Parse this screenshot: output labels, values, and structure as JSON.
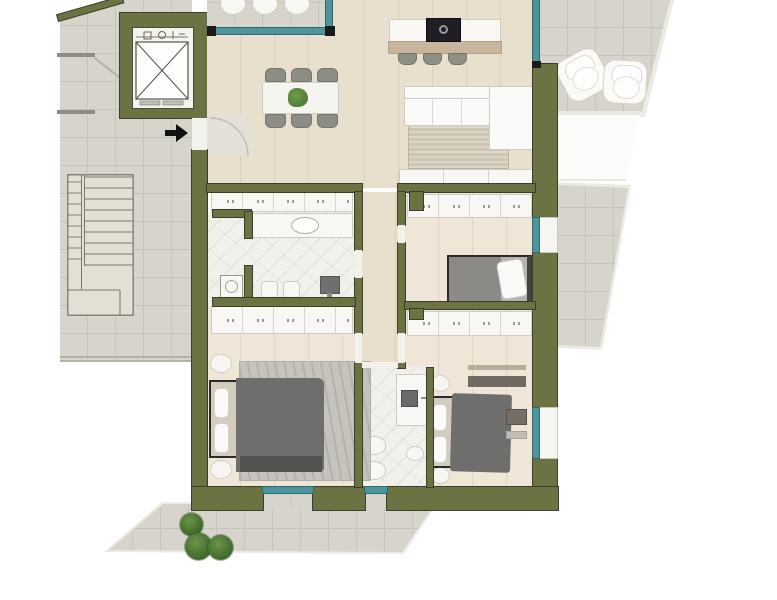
{
  "meta": {
    "kind": "rendered-floor-plan",
    "description": "Top-down 3D rendered apartment floor plan with olive-green walls, wood floors, two bathrooms, three bedrooms, open living-dining-kitchen, stairwell, elevator and terraces. No text labels are rendered.",
    "width_px": 777,
    "height_px": 600
  },
  "palette": {
    "wall": "#6c7342",
    "wallEdge": "#3c3e2c",
    "glass": "#4f939b",
    "glassEdge": "#2c6a71",
    "tile": "#d7d4cc",
    "tileLine": "#c7c4bb",
    "wood": "#e9dfcd",
    "woodLine": "#decfb8",
    "woodLight": "#efe6d7",
    "marble": "#f1f0eb",
    "furnWhite": "#f8f7f3",
    "furnEdge": "#cfccc4",
    "chair": "#8c8e85",
    "stool": "#8e9084",
    "cooktop": "#1f1f23",
    "islandWood": "#c8b59b",
    "sofa": "#fafaf8",
    "rugLiving": "#cfc5b3",
    "rugBedroom": "#c6c3bd",
    "duvet": "#6e6e6c",
    "duvetDark": "#525250",
    "mattress": "#d3cdbf",
    "bedFrame": "#2c2a27",
    "headboard": "#45433e",
    "plant": "#4e7c38",
    "bush": "#3f682c",
    "arrow": "#111111",
    "doorFill": "#f3f1ec",
    "stairLine": "#7a786f",
    "outline": "#b4b1a9",
    "post": "#1a1a1a",
    "terraceEdge": "#eceae3",
    "dresser": "#746e66"
  },
  "inventory": {
    "dining_chairs": 6,
    "dining_tables": 1,
    "kitchen_islands": 1,
    "bar_stools": 3,
    "sofas": 1,
    "beds": 3,
    "bathrooms": 2,
    "closet_runs": 4,
    "terrace_chairs_top": 3,
    "terrace_armchairs_right": 2,
    "bushes": 3,
    "elevators": 1,
    "staircases": 1,
    "entry_arrows": 1
  }
}
